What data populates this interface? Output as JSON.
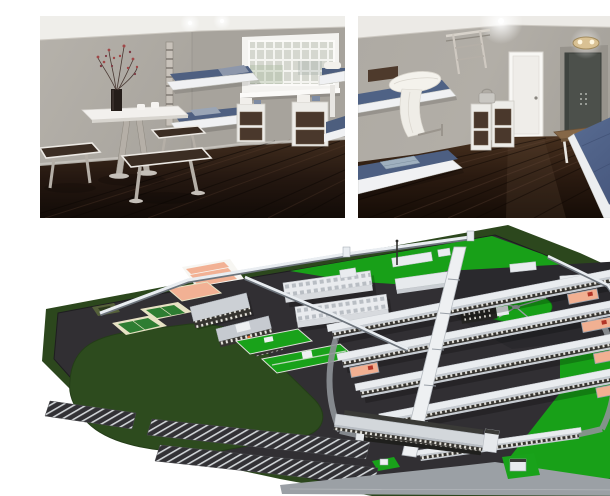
{
  "page": {
    "background_color": "#ffffff",
    "description": "Collage of three architectural renderings: two accommodation-room interiors above a 3D aerial site plan of a walled campus"
  },
  "panels": {
    "room_left": {
      "label": "Interior rendering: room with glass-block window, wall-mounted bunk beds, dining table with stools, flower vase and storage cabinets",
      "objects": [
        "flower-vase",
        "dining-table",
        "cups",
        "stool",
        "bench",
        "bunk-bed",
        "wall-ladder",
        "glass-block-window",
        "storage-cabinet",
        "wall-bunk",
        "ceiling-lights",
        "dark-wood-floor"
      ],
      "colors": {
        "wall": "#b0aca5",
        "ceiling": "#efeeea",
        "floor": "#1b120c",
        "bedding_blue": "#4f6081",
        "cabinet_front": "#4a382c",
        "frame_white": "#f0f1f3",
        "metal": "#b5afa7"
      }
    },
    "room_right": {
      "label": "Interior rendering: room with bunk bed, rolled bedding, storage cabinets, white door, steel security door, wall lamp, wooden bench and large blue bed with folded blankets",
      "objects": [
        "wall-ladder",
        "headboard-panel",
        "bunk-bed",
        "towel-roll",
        "storage-cabinet",
        "kettle",
        "white-door",
        "security-door",
        "wall-lamp",
        "ceiling-spotlight",
        "bed",
        "folded-blankets",
        "wood-bench",
        "wall-flowers",
        "dark-wood-floor"
      ],
      "colors": {
        "wall": "#b2aea7",
        "floor": "#241509",
        "bed_blue": "#52658b",
        "blanket_blue": "#a9c3d8",
        "security_door": "#4c504b",
        "lamp_brass": "#d9c193"
      }
    },
    "site_plan": {
      "label": "3D aerial rendering of a walled campus: rows of housing blocks with salmon courtyards, sports courts, workshop buildings, circular exercise yard, lawns, parking lot and entrance complex",
      "objects": [
        "outer-grass",
        "perimeter-wall",
        "asphalt-grounds",
        "meadow",
        "tennis-court",
        "sports-court-salmon",
        "workshop-buildings",
        "industrial-halls",
        "housing-row",
        "courtyard",
        "spine-corridor",
        "exercise-circle",
        "lawn",
        "parking-lot",
        "entrance-complex",
        "access-road",
        "gatehouse",
        "checker-building"
      ],
      "colors": {
        "outer_grass": "#2c471d",
        "asphalt": "#312f33",
        "lawn": "#18a018",
        "court_salmon": "#f2b194",
        "court_green": "#2e7d32",
        "court_border": "#e7e2c4",
        "building_white": "#e9ecef",
        "wall_white": "#e9edf1",
        "roof_gray": "#c7ccd2",
        "dark_building": "#232321",
        "road_gray": "#9ba0a5",
        "red_item": "#b23527"
      }
    }
  }
}
